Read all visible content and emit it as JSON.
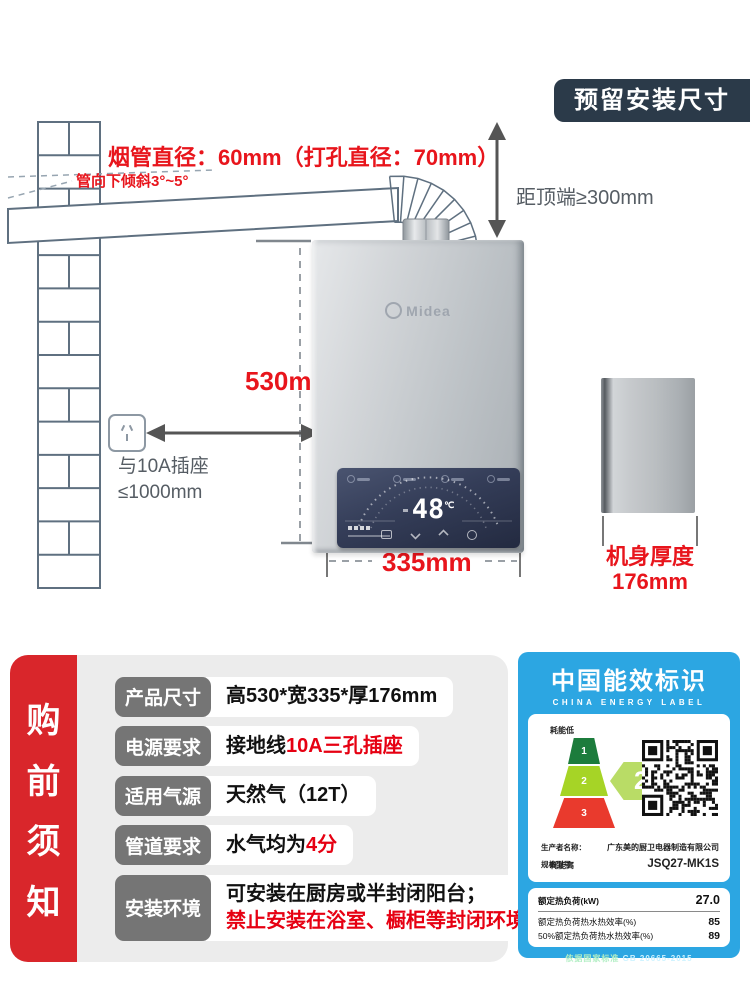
{
  "badge": "预留安装尺寸",
  "annotations": {
    "pipe_diameter": "烟管直径：60mm（打孔直径：70mm）",
    "pipe_slope": "管向下倾斜3°~5°",
    "top_clearance": "距顶端≥300mm",
    "height": "530mm",
    "width": "335mm",
    "outlet_line1": "与10A插座",
    "outlet_line2": "≤1000mm",
    "depth_label": "机身厚度",
    "depth_value": "176mm"
  },
  "heater": {
    "brand": "Midea",
    "display_temp": "48",
    "temp_unit": "℃"
  },
  "notice": {
    "sidebar": [
      "购",
      "前",
      "须",
      "知"
    ],
    "rows": [
      {
        "label": "产品尺寸",
        "value": [
          {
            "t": "高530*宽335*厚176mm",
            "red": false
          }
        ]
      },
      {
        "label": "电源要求",
        "value": [
          {
            "t": "接地线",
            "red": false
          },
          {
            "t": "10A三孔插座",
            "red": true
          }
        ]
      },
      {
        "label": "适用气源",
        "value": [
          {
            "t": "天然气（12T）",
            "red": false
          }
        ]
      },
      {
        "label": "管道要求",
        "value": [
          {
            "t": "水气均为",
            "red": false
          },
          {
            "t": "4分",
            "red": true
          }
        ]
      },
      {
        "label": "安装环境",
        "value": [
          {
            "t": "可安装在厨房或半封闭阳台；",
            "red": false
          },
          {
            "t": "禁止安装在浴室、橱柜等封闭环境",
            "red": true,
            "newline": true
          }
        ]
      }
    ]
  },
  "energy_label": {
    "title": "中国能效标识",
    "subtitle": "CHINA ENERGY LABEL",
    "low_label": "耗能低",
    "high_label": "耗能高",
    "grades": [
      "1",
      "2",
      "3"
    ],
    "grade_badge_num": "2",
    "grade_badge_suffix": "级",
    "producer_label": "生产者名称：",
    "producer": "广东美的厨卫电器制造有限公司",
    "model_label": "规格型号：",
    "model": "JSQ27-MK1S",
    "rows": [
      {
        "name": "额定热负荷(kW)",
        "value": "27.0"
      },
      {
        "name": "额定热负荷热水热效率(%)",
        "value": "85"
      },
      {
        "name": "50%额定热负荷热水热效率(%)",
        "value": "89"
      }
    ],
    "standard_label": "依据国家标准",
    "standard_value": "GB 20665-2015"
  },
  "colors": {
    "accent_red": "#e8151c",
    "badge_navy": "#2b3a49",
    "sidebar_red": "#d9262b",
    "energy_blue": "#2ca6e2",
    "grade1_green": "#1c7c3c",
    "grade2_green": "#a6d426",
    "grade3_red": "#e93a2d"
  }
}
